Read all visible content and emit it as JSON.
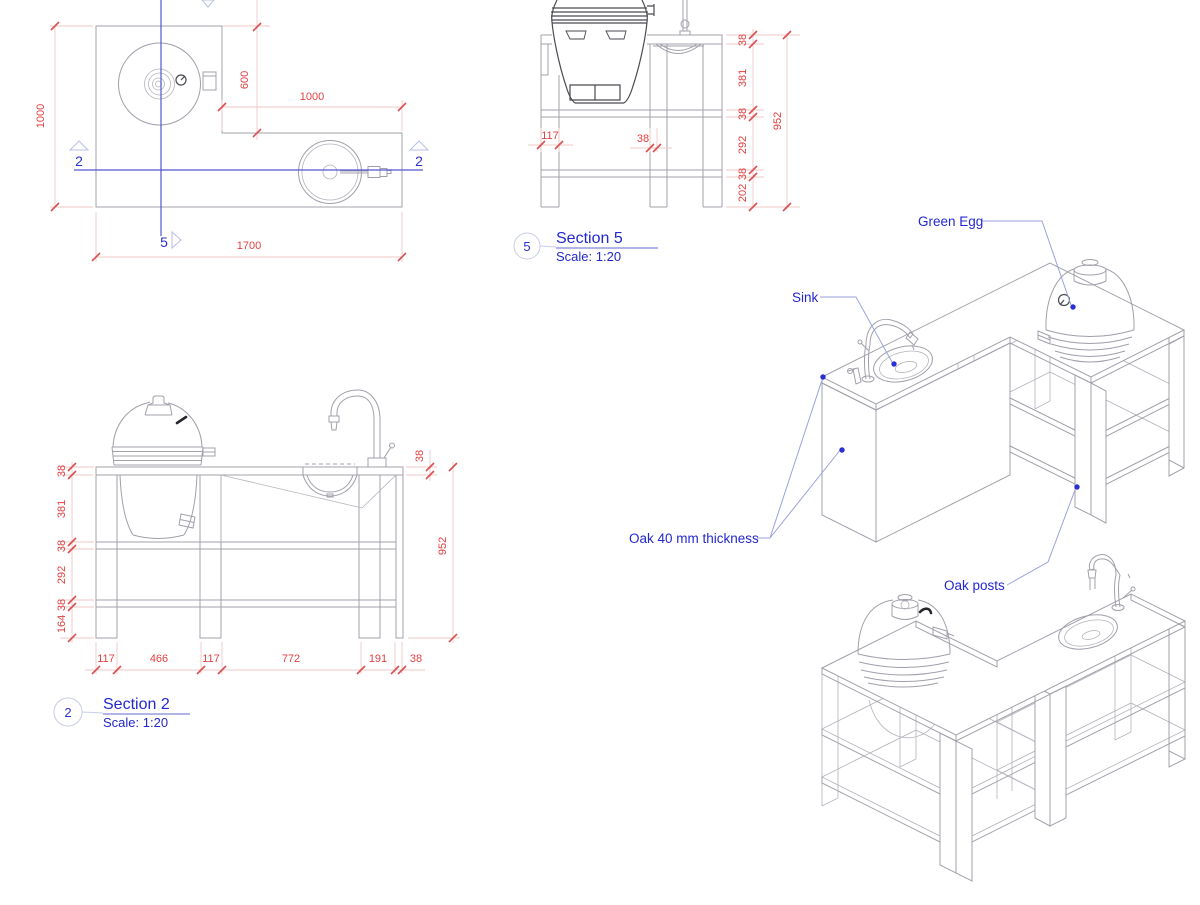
{
  "plan": {
    "dim_depth": "1000",
    "dim_inner_depth": "600",
    "dim_right_width": "1000",
    "dim_overall_width": "1700",
    "marker_section2": "2",
    "marker_section5": "5"
  },
  "section5": {
    "bubble": "5",
    "title": "Section 5",
    "scale": "Scale: 1:20",
    "dim_chain_right": [
      "38",
      "381",
      "38",
      "292",
      "38",
      "202"
    ],
    "dim_total_height": "952",
    "dims_bottom": [
      "117",
      "38"
    ]
  },
  "section2": {
    "bubble": "2",
    "title": "Section 2",
    "scale": "Scale: 1:20",
    "dim_chain_left": [
      "38",
      "381",
      "38",
      "292",
      "38",
      "164"
    ],
    "dim_counter_thickness": "38",
    "dim_total_height": "952",
    "dim_chain_bottom": [
      "117",
      "466",
      "117",
      "772",
      "191",
      "38"
    ]
  },
  "annotations": {
    "green_egg": "Green Egg",
    "sink": "Sink",
    "oak_thickness": "Oak 40 mm thickness",
    "oak_posts": "Oak posts"
  },
  "colors": {
    "dimension_red": "#e04141",
    "annotation_blue": "#2328cf",
    "drawing_gray": "#a0a0ab",
    "section_line_blue": "#5157cd"
  }
}
